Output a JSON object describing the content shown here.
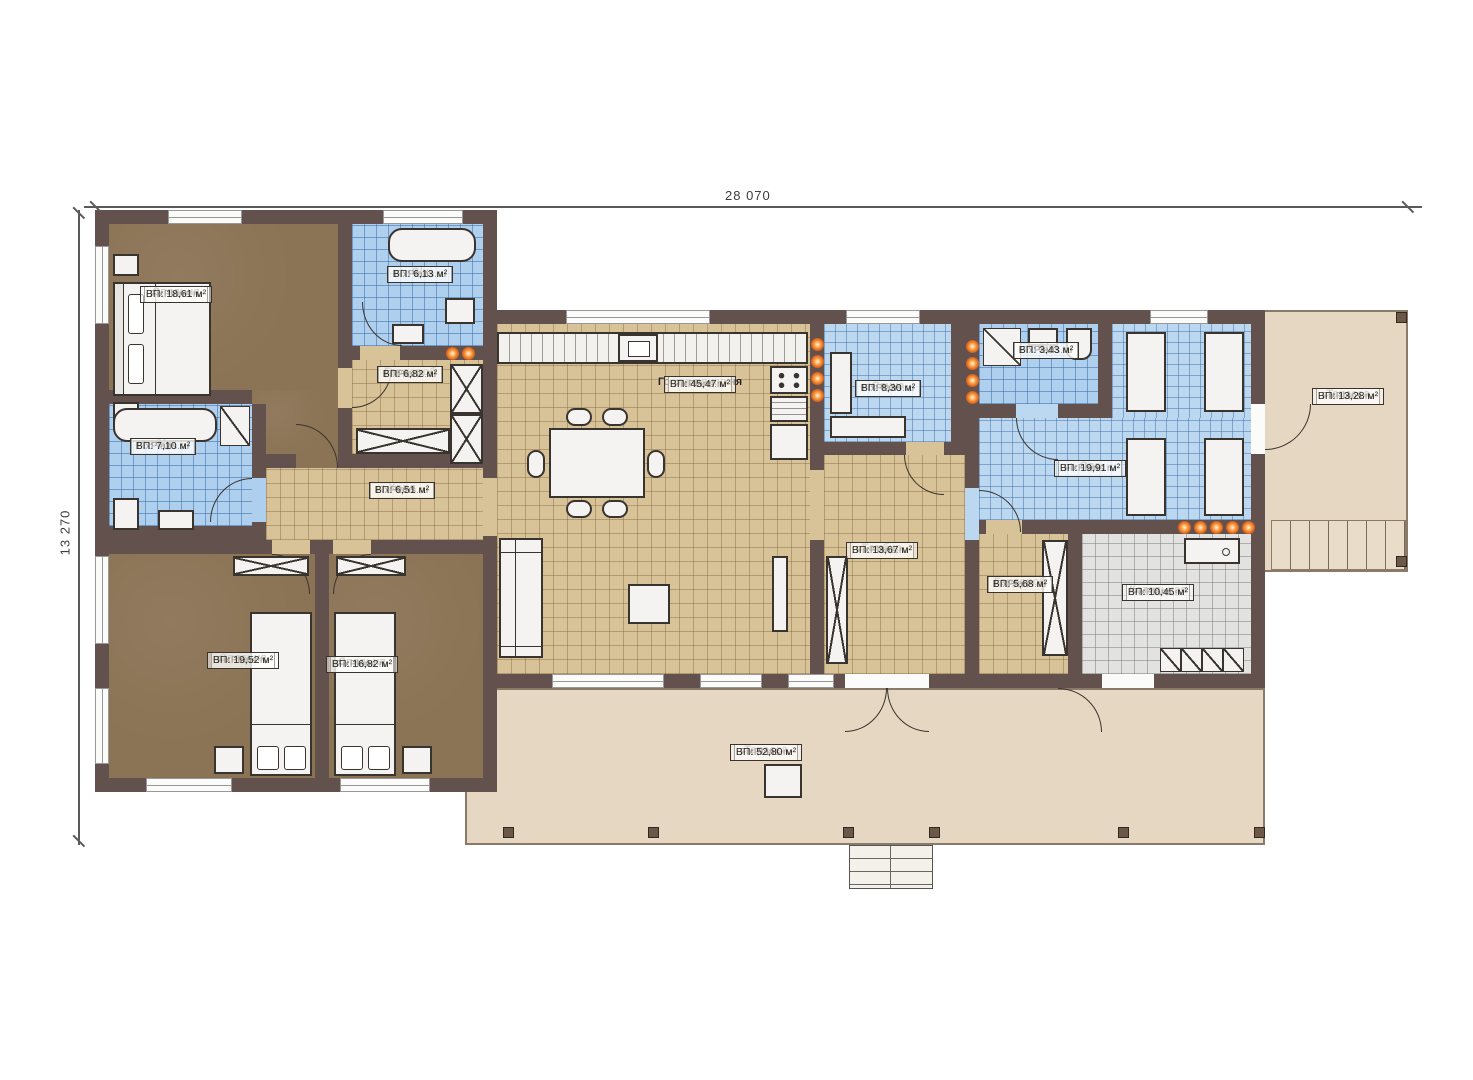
{
  "watermark": "FixPlans.ru",
  "dimensions": {
    "width_label": "28 070",
    "height_label": "13 270"
  },
  "rooms": [
    {
      "id": "bedroom1",
      "name": "Спальня",
      "area": "ВП: 18,61 м²"
    },
    {
      "id": "su1",
      "name": "С/у",
      "area": "ВП: 6,13 м²"
    },
    {
      "id": "wardrobe1",
      "name": "Гардероб",
      "area": "ВП: 6,82 м²"
    },
    {
      "id": "su2",
      "name": "С/у",
      "area": "ВП: 7,10 м²"
    },
    {
      "id": "hall",
      "name": "Холл",
      "area": "ВП: 6,51 м²"
    },
    {
      "id": "bedroom2",
      "name": "Спальня",
      "area": "ВП: 19,52 м²"
    },
    {
      "id": "bedroom3",
      "name": "Спальня",
      "area": "ВП: 16,82 м²"
    },
    {
      "id": "living_kitchen",
      "name": "Гостиная-кухня",
      "area": "ВП: 45,47 м²"
    },
    {
      "id": "sauna",
      "name": "Сауна",
      "area": "ВП: 8,30 м²"
    },
    {
      "id": "tambur",
      "name": "Тамбур",
      "area": "ВП: 13,67 м²"
    },
    {
      "id": "su3",
      "name": "С/у",
      "area": "ВП: 3,43 м²"
    },
    {
      "id": "spa",
      "name": "Спа",
      "area": "ВП: 19,91 м²"
    },
    {
      "id": "wardrobe2",
      "name": "Гардероб",
      "area": "ВП: 5,68 м²"
    },
    {
      "id": "boiler",
      "name": "Котельная",
      "area": "ВП: 10,45 м²"
    },
    {
      "id": "terrace_right",
      "name": "Терасса",
      "area": "ВП: 13,28 м²"
    },
    {
      "id": "terrace_bottom",
      "name": "Терасса",
      "area": "ВП: 52,80 м²"
    }
  ],
  "colors": {
    "wall": "#63514e",
    "bedroom_floor": "#8b7355",
    "tile_beige": "#d8c298",
    "tile_blue": "#aecfed",
    "tile_gray": "#e2e2e1",
    "terrace": "#e6d7c2",
    "light_accent": "#e4661c"
  }
}
